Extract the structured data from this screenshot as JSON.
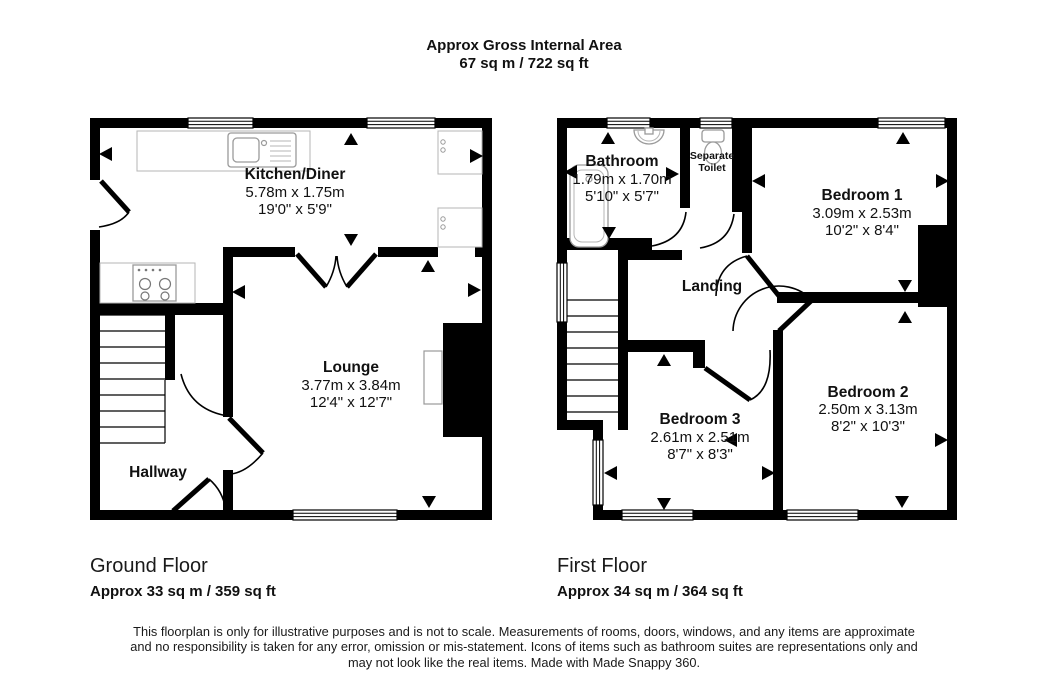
{
  "title": {
    "line1": "Approx Gross Internal Area",
    "line2": "67 sq m / 722 sq ft"
  },
  "ground_floor": {
    "label": "Ground Floor",
    "area": "Approx 33 sq m / 359 sq ft",
    "rooms": {
      "kitchen": {
        "name": "Kitchen/Diner",
        "metric": "5.78m x 1.75m",
        "imperial": "19'0\" x 5'9\""
      },
      "lounge": {
        "name": "Lounge",
        "metric": "3.77m x 3.84m",
        "imperial": "12'4\" x 12'7\""
      },
      "hallway": {
        "name": "Hallway"
      }
    }
  },
  "first_floor": {
    "label": "First Floor",
    "area": "Approx 34 sq m / 364 sq ft",
    "rooms": {
      "bathroom": {
        "name": "Bathroom",
        "metric": "1.79m x 1.70m",
        "imperial": "5'10\" x 5'7\""
      },
      "separate_toilet": {
        "line1": "Separate",
        "line2": "Toilet"
      },
      "bedroom1": {
        "name": "Bedroom 1",
        "metric": "3.09m x 2.53m",
        "imperial": "10'2\" x 8'4\""
      },
      "bedroom2": {
        "name": "Bedroom 2",
        "metric": "2.50m x 3.13m",
        "imperial": "8'2\" x 10'3\""
      },
      "bedroom3": {
        "name": "Bedroom 3",
        "metric": "2.61m x 2.51m",
        "imperial": "8'7\" x 8'3\""
      },
      "landing": {
        "name": "Landing"
      }
    }
  },
  "disclaimer": {
    "line1": "This floorplan is only for illustrative purposes and is not to scale. Measurements of rooms, doors, windows, and any items are approximate",
    "line2": "and no responsibility is taken for any error, omission or mis-statement. Icons of items such as bathroom suites are representations only and",
    "line3": "may not look like the real items. Made with Made Snappy 360."
  },
  "icons": [
    "kitchen-sink",
    "hob",
    "bath",
    "basin",
    "toilet",
    "stairs",
    "chimney-breast",
    "tv"
  ],
  "colors": {
    "wall": "#000000",
    "fixture_outline": "#9a9a9a",
    "background": "#ffffff"
  }
}
